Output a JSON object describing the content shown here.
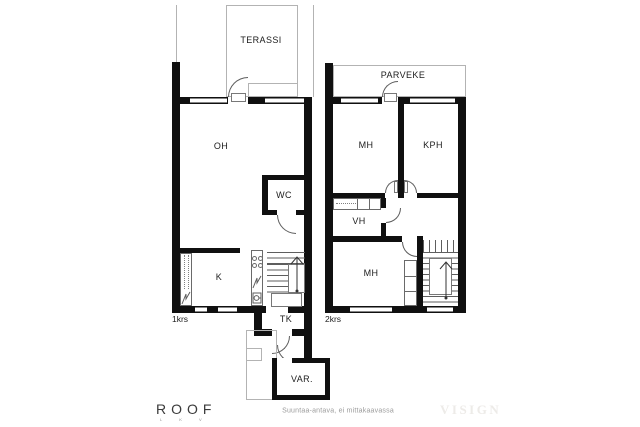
{
  "plan": {
    "floor1": {
      "floor_label": "1krs",
      "terrace_label": "TERASSI",
      "living_room_label": "OH",
      "wc_label": "WC",
      "kitchen_label": "K",
      "utility_label": "TK"
    },
    "floor2": {
      "floor_label": "2krs",
      "balcony_label": "PARVEKE",
      "bedroom1_label": "MH",
      "bathroom_label": "KPH",
      "closet_label": "VH",
      "bedroom2_label": "MH"
    },
    "storage_label": "VAR."
  },
  "footer": {
    "brand": "ROOF",
    "brand_sub": "L K V",
    "disclaimer": "Suuntaa-antava, ei mittakaavassa",
    "watermark": "VISIGN"
  },
  "colors": {
    "wall": "#101010",
    "line": "#5e5e5e",
    "fixture_line": "#6a6a6a",
    "light_outline": "#b3b3b3",
    "text": "#1c1c1c",
    "disclaimer_text": "#9b9b9b",
    "watermark_text": "#edebe8",
    "brand_text": "#3a3a3a",
    "background": "#ffffff"
  }
}
